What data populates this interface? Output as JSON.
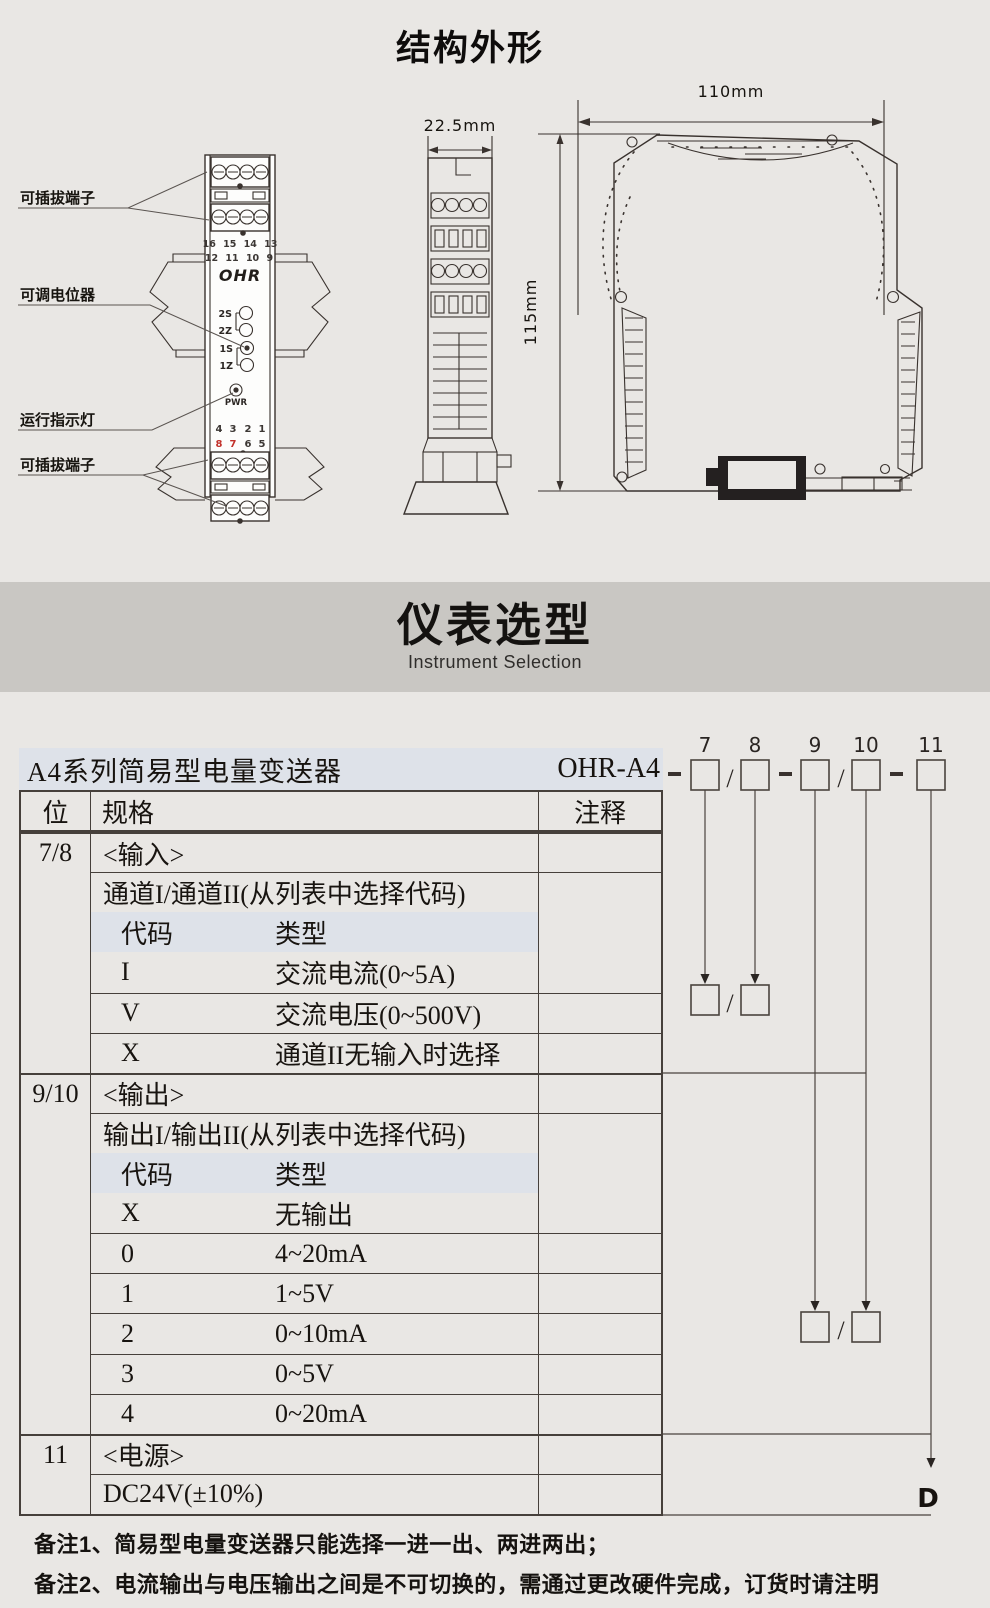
{
  "page": {
    "title": "结构外形"
  },
  "drawing": {
    "labels": {
      "plug_top": "可插拔端子",
      "pot": "可调电位器",
      "run_led": "运行指示灯",
      "plug_bottom": "可插拔端子"
    },
    "front": {
      "logo": "OHR",
      "terminals_top_row1": "16 15 14 13",
      "terminals_top_row2": "12 11 10 9",
      "pots": [
        "2S",
        "2Z",
        "1S",
        "1Z"
      ],
      "pwr": "PWR",
      "terminals_bottom_row1": [
        "4",
        "3",
        "2",
        "1"
      ],
      "terminals_bottom_row2": [
        "8",
        "7",
        "6",
        "5"
      ]
    },
    "dims": {
      "width_side": "22.5mm",
      "height": "115mm",
      "width_front": "110mm"
    }
  },
  "band": {
    "title": "仪表选型",
    "subtitle": "Instrument Selection"
  },
  "selection": {
    "series_title": "A4系列简易型电量变送器",
    "model_prefix": "OHR-A4",
    "digits": [
      "7",
      "8",
      "9",
      "10",
      "11"
    ],
    "slash": "/",
    "power_code": "D",
    "table": {
      "headers": {
        "pos": "位",
        "spec": "规格",
        "note": "注释"
      },
      "rows": [
        {
          "pos": "7/8",
          "c1": "<输入>"
        },
        {
          "c1": "通道I/通道II(从列表中选择代码)"
        },
        {
          "c1": "代码",
          "c2": "类型"
        },
        {
          "c1": "I",
          "c2": "交流电流(0~5A)"
        },
        {
          "c1": "V",
          "c2": "交流电压(0~500V)"
        },
        {
          "c1": "X",
          "c2": "通道II无输入时选择"
        },
        {
          "pos": "9/10",
          "c1": "<输出>"
        },
        {
          "c1": "输出I/输出II(从列表中选择代码)"
        },
        {
          "c1": "代码",
          "c2": "类型"
        },
        {
          "c1": "X",
          "c2": "无输出"
        },
        {
          "c1": "0",
          "c2": "4~20mA"
        },
        {
          "c1": "1",
          "c2": "1~5V"
        },
        {
          "c1": "2",
          "c2": "0~10mA"
        },
        {
          "c1": "3",
          "c2": "0~5V"
        },
        {
          "c1": "4",
          "c2": "0~20mA"
        },
        {
          "pos": "11",
          "c1": "<电源>"
        },
        {
          "c1": "DC24V(±10%)"
        }
      ]
    }
  },
  "notes": {
    "n1": "备注1、简易型电量变送器只能选择一进一出、两进两出；",
    "n2": "备注2、电流输出与电压输出之间是不可切换的，需通过更改硬件完成，订货时请注明"
  }
}
